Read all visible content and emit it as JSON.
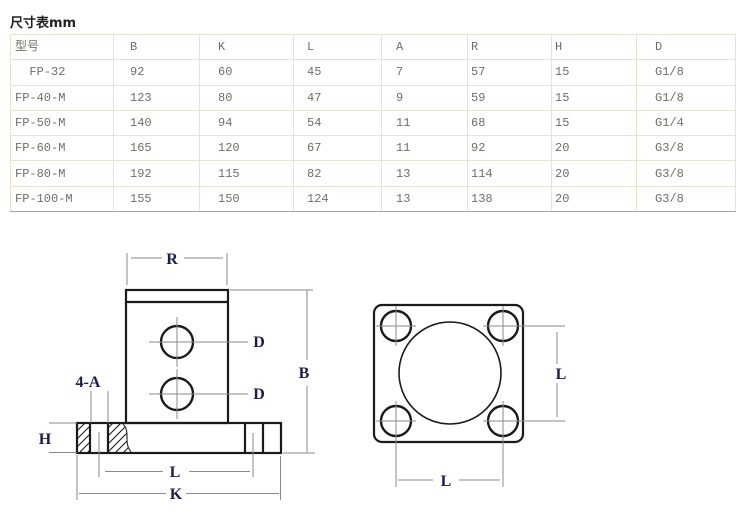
{
  "title": "尺寸表mm",
  "table": {
    "headers": [
      "型号",
      "B",
      "K",
      "L",
      "A",
      "R",
      "H",
      "D"
    ],
    "rows": [
      [
        "  FP-32",
        "92",
        "60",
        "45",
        "7",
        "57",
        "15",
        "G1/8"
      ],
      [
        "FP-40-M",
        "123",
        "80",
        "47",
        "9",
        "59",
        "15",
        "G1/8"
      ],
      [
        "FP-50-M",
        "140",
        "94",
        "54",
        "11",
        "68",
        "15",
        "G1/4"
      ],
      [
        "FP-60-M",
        "165",
        "120",
        "67",
        "11",
        "92",
        "20",
        "G3/8"
      ],
      [
        "FP-80-M",
        "192",
        "115",
        "82",
        "13",
        "114",
        "20",
        "G3/8"
      ],
      [
        "FP-100-M",
        "155",
        "150",
        "124",
        "13",
        "138",
        "20",
        "G3/8"
      ]
    ]
  },
  "drawings": {
    "front_view": {
      "labels": {
        "body_width": "R",
        "total_height": "B",
        "port_top": "D",
        "port_bottom": "D",
        "mount_holes": "4-A",
        "flange_thickness": "H",
        "hole_spacing": "L",
        "flange_width": "K"
      }
    },
    "top_view": {
      "labels": {
        "hole_spacing_vertical": "L",
        "hole_spacing_horizontal": "L"
      }
    },
    "colors": {
      "outline": "#1a1a1a",
      "dimension_line": "#8a8a8a",
      "label_text": "#1c1c4e",
      "table_border": "#e7e2d2",
      "table_bottom_border": "#a2a2a8",
      "table_text": "#6f6f66"
    }
  }
}
